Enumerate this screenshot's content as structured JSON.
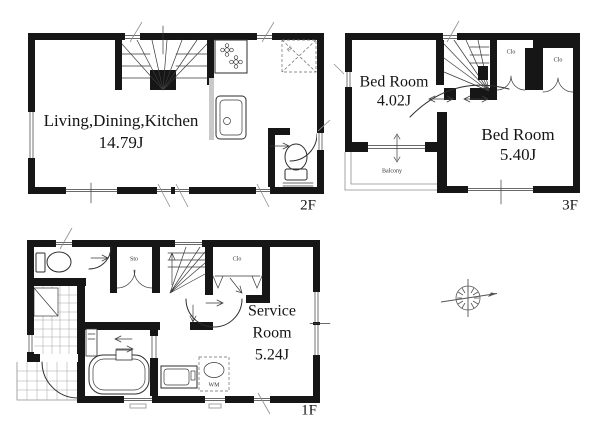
{
  "colors": {
    "wall": "#161616",
    "line": "#2e2e2e",
    "thin_line": "#8f8f8f",
    "background": "#ffffff"
  },
  "floor_2f": {
    "floor_label": "2F",
    "ldk_name": "Living,Dining,Kitchen",
    "ldk_size": "14.79J",
    "refrigerator_label": "RF"
  },
  "floor_3f": {
    "floor_label": "3F",
    "bedroom_a_name": "Bed Room",
    "bedroom_a_size": "4.02J",
    "bedroom_b_name": "Bed Room",
    "bedroom_b_size": "5.40J",
    "closet_a_label": "Clo",
    "closet_b_label": "Clo",
    "balcony_label": "Balcony"
  },
  "floor_1f": {
    "floor_label": "1F",
    "service_room_name_line1": "Service",
    "service_room_name_line2": "Room",
    "service_room_size": "5.24J",
    "storage_label": "Sto",
    "closet_label": "Clo",
    "washing_machine_label": "WM"
  }
}
